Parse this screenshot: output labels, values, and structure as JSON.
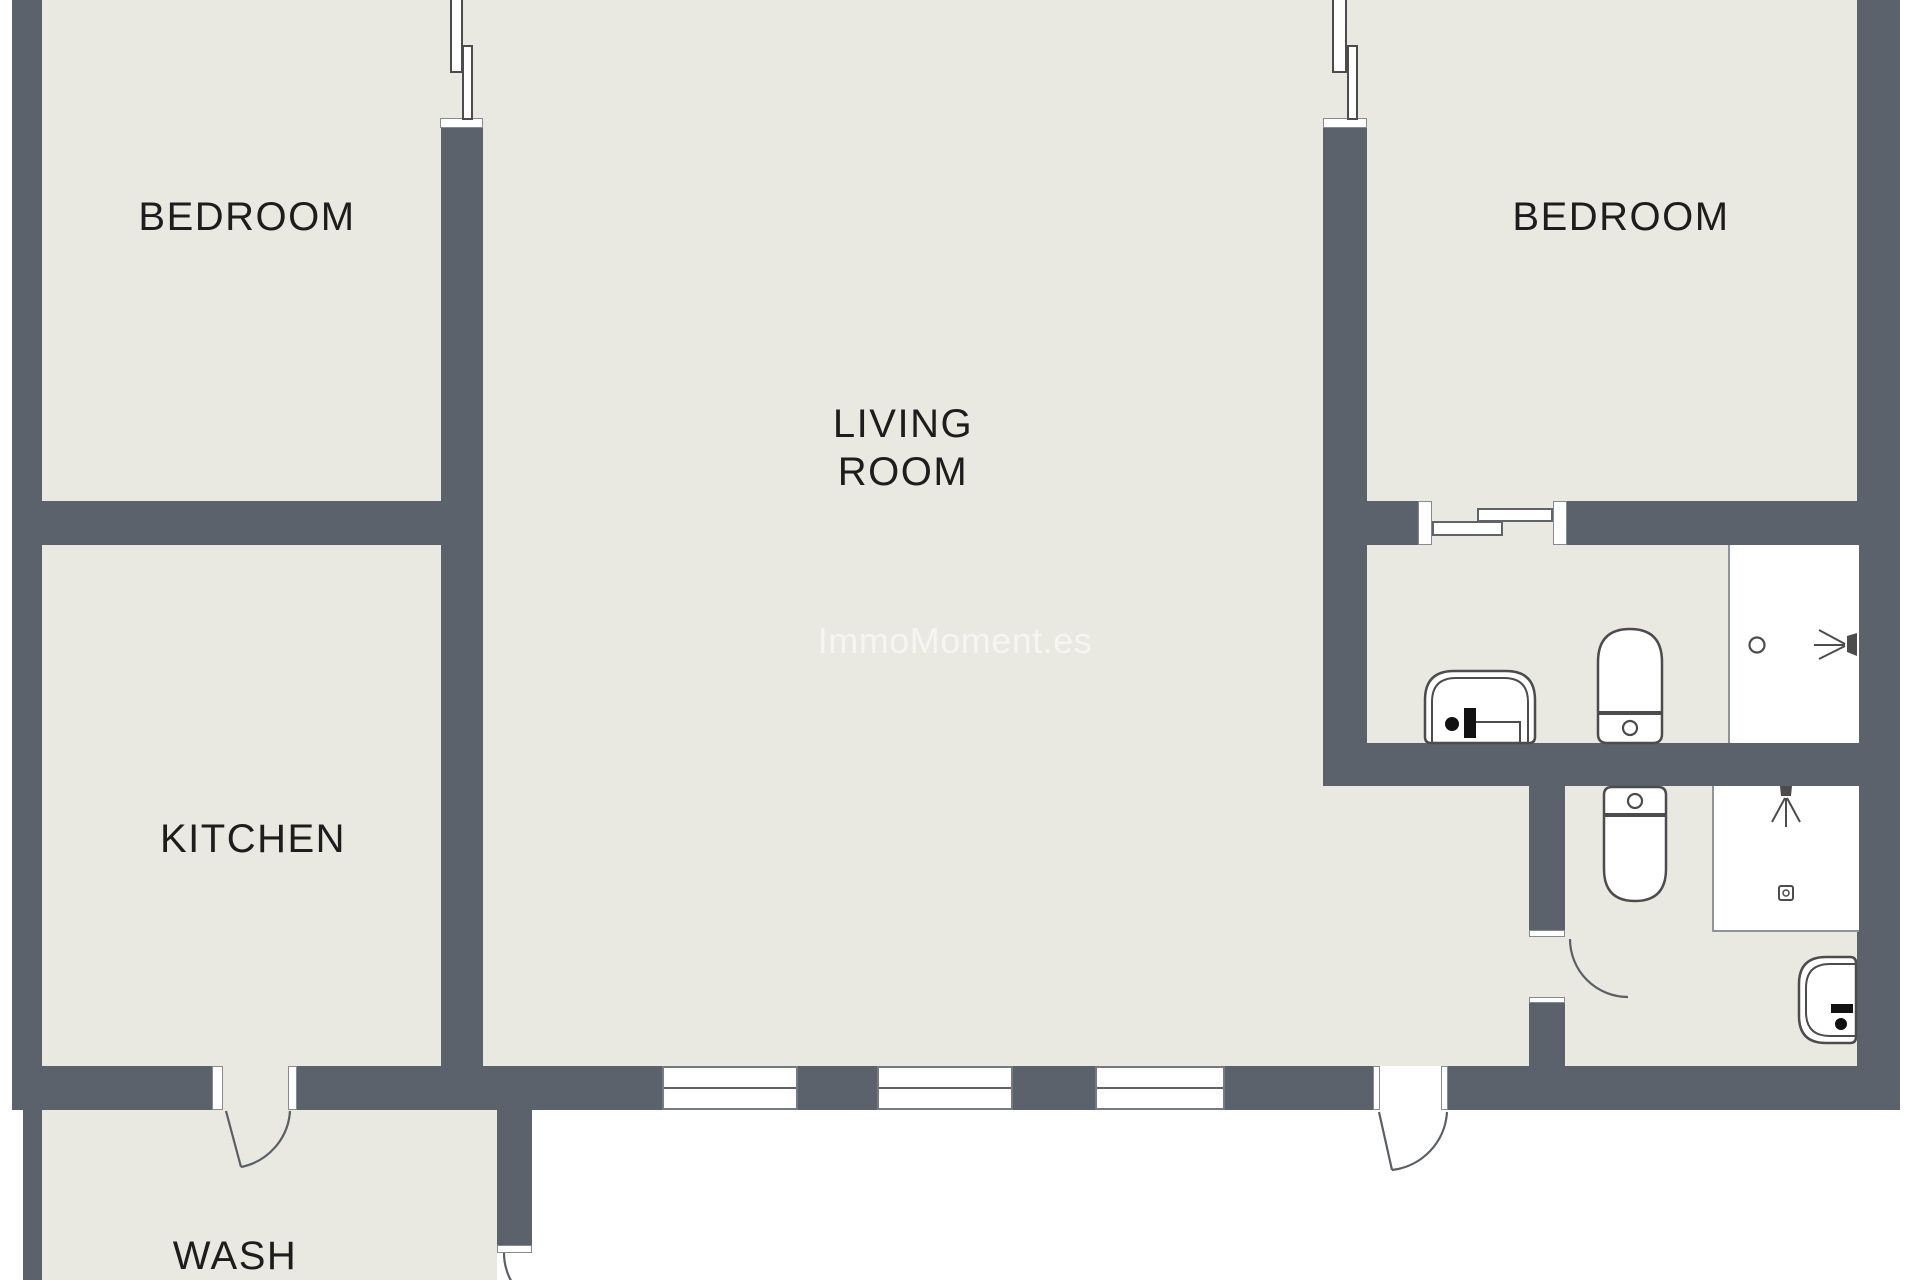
{
  "plan_type": "apartment floor plan",
  "colors": {
    "outside_background": "#ffffff",
    "floor": "#e9e9e1",
    "wall": "#5c626b",
    "fixture_outline": "#4c4c4c",
    "label_text": "#1d1d1d",
    "watermark_text": "#ffffff"
  },
  "rooms": {
    "bedroom_left": {
      "label": "BEDROOM"
    },
    "bedroom_right": {
      "label": "BEDROOM"
    },
    "living": {
      "label": "LIVING ROOM"
    },
    "kitchen": {
      "label": "KITCHEN"
    },
    "wash": {
      "label": "WASH"
    }
  },
  "watermark": {
    "text": "ImmoMoment.es"
  },
  "fixtures": {
    "bathroom_upper": [
      "sink",
      "toilet",
      "shower"
    ],
    "bathroom_lower": [
      "toilet",
      "shower",
      "sink"
    ],
    "doors": [
      "kitchen-wash-door",
      "living-exterior-door",
      "bathroom-lower-door",
      "wash-exterior-door",
      "bedroom-bathroom-sliding-door"
    ],
    "windows": [
      "bedroom-left-window",
      "bedroom-right-window",
      "living-window-1",
      "living-window-2",
      "living-window-3"
    ]
  }
}
